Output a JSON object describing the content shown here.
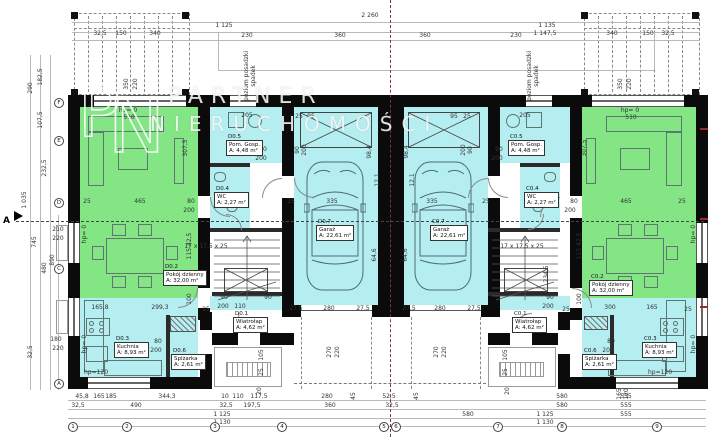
{
  "watermark": {
    "monogram_p": "P",
    "monogram_n": "N",
    "line1": "PARTNER",
    "line2": "NIERUCHOMOŚCI"
  },
  "section": {
    "label": "A"
  },
  "colors": {
    "room_green": "#84e584",
    "room_cyan": "#b4eef0",
    "wall": "#0b0b0b",
    "axis_red": "#9b2b2b"
  },
  "rooms": [
    {
      "id": "D0.1",
      "name": "Wiatrołap",
      "area": "A: 4,62 m²",
      "x": 233,
      "y": 311
    },
    {
      "id": "D0.2",
      "name": "Pokój dzienny",
      "area": "A: 32,00 m²",
      "x": 163,
      "y": 264
    },
    {
      "id": "D0.3",
      "name": "Kuchnia",
      "area": "A: 8,93 m²",
      "x": 114,
      "y": 336
    },
    {
      "id": "D0.4",
      "name": "WC",
      "area": "A: 2,27 m²",
      "x": 214,
      "y": 186
    },
    {
      "id": "D0.5",
      "name": "Pom. Gosp.",
      "area": "A: 4,48 m²",
      "x": 226,
      "y": 134
    },
    {
      "id": "D0.6",
      "name": "Spiżarka",
      "area": "A: 2,61 m²",
      "x": 171,
      "y": 348
    },
    {
      "id": "D0.7",
      "name": "Garaż",
      "area": "A: 22,61 m²",
      "x": 316,
      "y": 219
    },
    {
      "id": "C0.1",
      "name": "Wiatrołap",
      "area": "A: 4,62 m²",
      "x": 512,
      "y": 311
    },
    {
      "id": "C0.2",
      "name": "Pokój dzienny",
      "area": "A: 32,00 m²",
      "x": 589,
      "y": 274
    },
    {
      "id": "C0.3",
      "name": "Kuchnia",
      "area": "A: 8,93 m²",
      "x": 642,
      "y": 336
    },
    {
      "id": "C0.4",
      "name": "WC",
      "area": "A: 2,27 m²",
      "x": 524,
      "y": 186
    },
    {
      "id": "C0.5",
      "name": "Pom. Gosp.",
      "area": "A: 4,48 m²",
      "x": 508,
      "y": 134
    },
    {
      "id": "C0.6",
      "name": "Spiżarka",
      "area": "A: 2,61 m²",
      "x": 582,
      "y": 348
    },
    {
      "id": "C0.7",
      "name": "Garaż",
      "area": "A: 22,61 m²",
      "x": 430,
      "y": 219
    }
  ],
  "labels": [
    [
      "2 260",
      370,
      16,
      0
    ],
    [
      "1 125",
      224,
      26,
      0
    ],
    [
      "1 135",
      547,
      26,
      0
    ],
    [
      "1 147,5",
      545,
      34,
      0
    ],
    [
      "230",
      247,
      36,
      0
    ],
    [
      "360",
      340,
      36,
      0
    ],
    [
      "360",
      425,
      36,
      0
    ],
    [
      "230",
      516,
      36,
      0
    ],
    [
      "32,5",
      100,
      34,
      0
    ],
    [
      "150",
      121,
      34,
      0
    ],
    [
      "340",
      155,
      34,
      0
    ],
    [
      "340",
      612,
      34,
      0
    ],
    [
      "150",
      648,
      34,
      0
    ],
    [
      "32,5",
      668,
      34,
      0
    ],
    [
      "350",
      127,
      84,
      1
    ],
    [
      "220",
      136,
      84,
      1
    ],
    [
      "350",
      621,
      84,
      1
    ],
    [
      "220",
      630,
      84,
      1
    ],
    [
      "hp= 0",
      128,
      111,
      0
    ],
    [
      "510",
      129,
      118,
      0
    ],
    [
      "hp= 0",
      630,
      111,
      0
    ],
    [
      "510",
      631,
      118,
      0
    ],
    [
      "290",
      31,
      88,
      1
    ],
    [
      "182,5",
      41,
      77,
      1
    ],
    [
      "107,5",
      41,
      120,
      1
    ],
    [
      "232,5",
      45,
      168,
      1
    ],
    [
      "1 035",
      25,
      200,
      1
    ],
    [
      "745",
      35,
      242,
      1
    ],
    [
      "210",
      58,
      230,
      0
    ],
    [
      "220",
      58,
      239,
      0
    ],
    [
      "480",
      45,
      268,
      1
    ],
    [
      "890",
      53,
      260,
      1
    ],
    [
      "180",
      56,
      340,
      0
    ],
    [
      "220",
      58,
      349,
      0
    ],
    [
      "32,5",
      31,
      352,
      1
    ],
    [
      "hp= 0",
      85,
      234,
      1
    ],
    [
      "hp= 0",
      85,
      344,
      1
    ],
    [
      "25",
      87,
      202,
      0
    ],
    [
      "465",
      140,
      202,
      0
    ],
    [
      "80",
      191,
      202,
      0
    ],
    [
      "200",
      189,
      211,
      0
    ],
    [
      "307,5",
      186,
      148,
      1
    ],
    [
      "115  42,5",
      190,
      246,
      1
    ],
    [
      "100",
      190,
      299,
      1
    ],
    [
      "165,8",
      100,
      308,
      0
    ],
    [
      "299,3",
      160,
      308,
      0
    ],
    [
      "25",
      206,
      310,
      0
    ],
    [
      "80",
      158,
      342,
      0
    ],
    [
      "200",
      156,
      351,
      0
    ],
    [
      "hp=120",
      96,
      373,
      0
    ],
    [
      "205",
      247,
      116,
      0
    ],
    [
      "25",
      299,
      117,
      0
    ],
    [
      "95",
      311,
      117,
      0
    ],
    [
      "90",
      263,
      150,
      0
    ],
    [
      "200",
      261,
      159,
      0
    ],
    [
      "90",
      298,
      150,
      1
    ],
    [
      "200",
      305,
      150,
      1
    ],
    [
      "17 x 17,5 x 25",
      206,
      247,
      0
    ],
    [
      "90",
      224,
      298,
      0
    ],
    [
      "90",
      268,
      298,
      0
    ],
    [
      "200",
      223,
      307,
      0
    ],
    [
      "110",
      240,
      307,
      0
    ],
    [
      "105",
      262,
      355,
      1
    ],
    [
      "25",
      262,
      372,
      1
    ],
    [
      "20",
      260,
      391,
      1
    ],
    [
      "25",
      291,
      202,
      0
    ],
    [
      "335",
      332,
      202,
      0
    ],
    [
      "98,4",
      370,
      152,
      1
    ],
    [
      "12,1",
      378,
      180,
      1
    ],
    [
      "64,6",
      375,
      255,
      1
    ],
    [
      "27,5",
      296,
      309,
      0
    ],
    [
      "280",
      329,
      309,
      0
    ],
    [
      "27,5",
      363,
      309,
      0
    ],
    [
      "270",
      330,
      352,
      1
    ],
    [
      "220",
      338,
      352,
      1
    ],
    [
      "45",
      354,
      396,
      1
    ],
    [
      "335",
      432,
      202,
      0
    ],
    [
      "25",
      486,
      202,
      0
    ],
    [
      "98,4",
      407,
      152,
      1
    ],
    [
      "12,1",
      413,
      180,
      1
    ],
    [
      "64,6",
      406,
      255,
      1
    ],
    [
      "27,5",
      409,
      309,
      0
    ],
    [
      "280",
      440,
      309,
      0
    ],
    [
      "27,5",
      474,
      309,
      0
    ],
    [
      "270",
      437,
      352,
      1
    ],
    [
      "220",
      445,
      352,
      1
    ],
    [
      "45",
      417,
      396,
      1
    ],
    [
      "95",
      454,
      117,
      0
    ],
    [
      "25",
      467,
      117,
      0
    ],
    [
      "205",
      525,
      116,
      0
    ],
    [
      "90",
      499,
      150,
      0
    ],
    [
      "200",
      497,
      159,
      0
    ],
    [
      "200",
      464,
      150,
      1
    ],
    [
      "90",
      471,
      150,
      1
    ],
    [
      "17 x 17,5 x 25",
      522,
      247,
      0
    ],
    [
      "90",
      550,
      298,
      0
    ],
    [
      "200",
      548,
      307,
      0
    ],
    [
      "25",
      566,
      310,
      0
    ],
    [
      "80",
      574,
      202,
      0
    ],
    [
      "200",
      570,
      211,
      0
    ],
    [
      "465",
      626,
      202,
      0
    ],
    [
      "25",
      682,
      202,
      0
    ],
    [
      "307,5",
      585,
      148,
      1
    ],
    [
      "115  42,5",
      580,
      246,
      1
    ],
    [
      "100",
      580,
      299,
      1
    ],
    [
      "234,5",
      547,
      274,
      1
    ],
    [
      "300",
      610,
      308,
      0
    ],
    [
      "165",
      652,
      308,
      0
    ],
    [
      "25",
      688,
      310,
      0
    ],
    [
      "80",
      611,
      342,
      0
    ],
    [
      "200",
      608,
      351,
      0
    ],
    [
      "hp=120",
      660,
      373,
      0
    ],
    [
      "105",
      506,
      355,
      1
    ],
    [
      "25",
      506,
      372,
      1
    ],
    [
      "20",
      508,
      391,
      1
    ],
    [
      "hp= 0",
      694,
      234,
      1
    ],
    [
      "hp= 0",
      694,
      344,
      1
    ],
    [
      "165",
      620,
      394,
      1
    ],
    [
      "120",
      627,
      394,
      1
    ],
    [
      "45,8",
      82,
      397,
      0
    ],
    [
      "165",
      99,
      397,
      0
    ],
    [
      "185",
      111,
      397,
      0
    ],
    [
      "344,3",
      167,
      397,
      0
    ],
    [
      "10",
      225,
      397,
      0
    ],
    [
      "110",
      238,
      397,
      0
    ],
    [
      "117,5",
      259,
      397,
      0
    ],
    [
      "280",
      327,
      397,
      0
    ],
    [
      "52,5",
      389,
      397,
      0
    ],
    [
      "580",
      562,
      397,
      0
    ],
    [
      "555",
      626,
      397,
      0
    ],
    [
      "32,5",
      78,
      406,
      0
    ],
    [
      "490",
      136,
      406,
      0
    ],
    [
      "32,5",
      226,
      406,
      0
    ],
    [
      "197,5",
      252,
      406,
      0
    ],
    [
      "360",
      330,
      406,
      0
    ],
    [
      "32,5",
      392,
      406,
      0
    ],
    [
      "580",
      562,
      406,
      0
    ],
    [
      "555",
      626,
      406,
      0
    ],
    [
      "1 125",
      222,
      415,
      0
    ],
    [
      "580",
      468,
      415,
      0
    ],
    [
      "1 125",
      545,
      415,
      0
    ],
    [
      "555",
      626,
      415,
      0
    ],
    [
      "1 130",
      222,
      423,
      0
    ],
    [
      "1 130",
      545,
      423,
      0
    ],
    [
      "poziom posadzki",
      247,
      76,
      1
    ],
    [
      "spadek",
      254,
      76,
      1
    ],
    [
      "poziom posadzki",
      530,
      76,
      1
    ],
    [
      "spadek",
      537,
      76,
      1
    ]
  ],
  "grid_bubbles_bottom": [
    {
      "label": "1",
      "x": 73
    },
    {
      "label": "2",
      "x": 127
    },
    {
      "label": "3",
      "x": 215
    },
    {
      "label": "4",
      "x": 282
    },
    {
      "label": "5",
      "x": 384
    },
    {
      "label": "6",
      "x": 396
    },
    {
      "label": "7",
      "x": 498
    },
    {
      "label": "8",
      "x": 562
    },
    {
      "label": "9",
      "x": 657
    }
  ],
  "grid_bubbles_left": [
    {
      "label": "F",
      "y": 103
    },
    {
      "label": "E",
      "y": 141
    },
    {
      "label": "D",
      "y": 203
    },
    {
      "label": "C",
      "y": 269
    },
    {
      "label": "A",
      "y": 384
    }
  ]
}
